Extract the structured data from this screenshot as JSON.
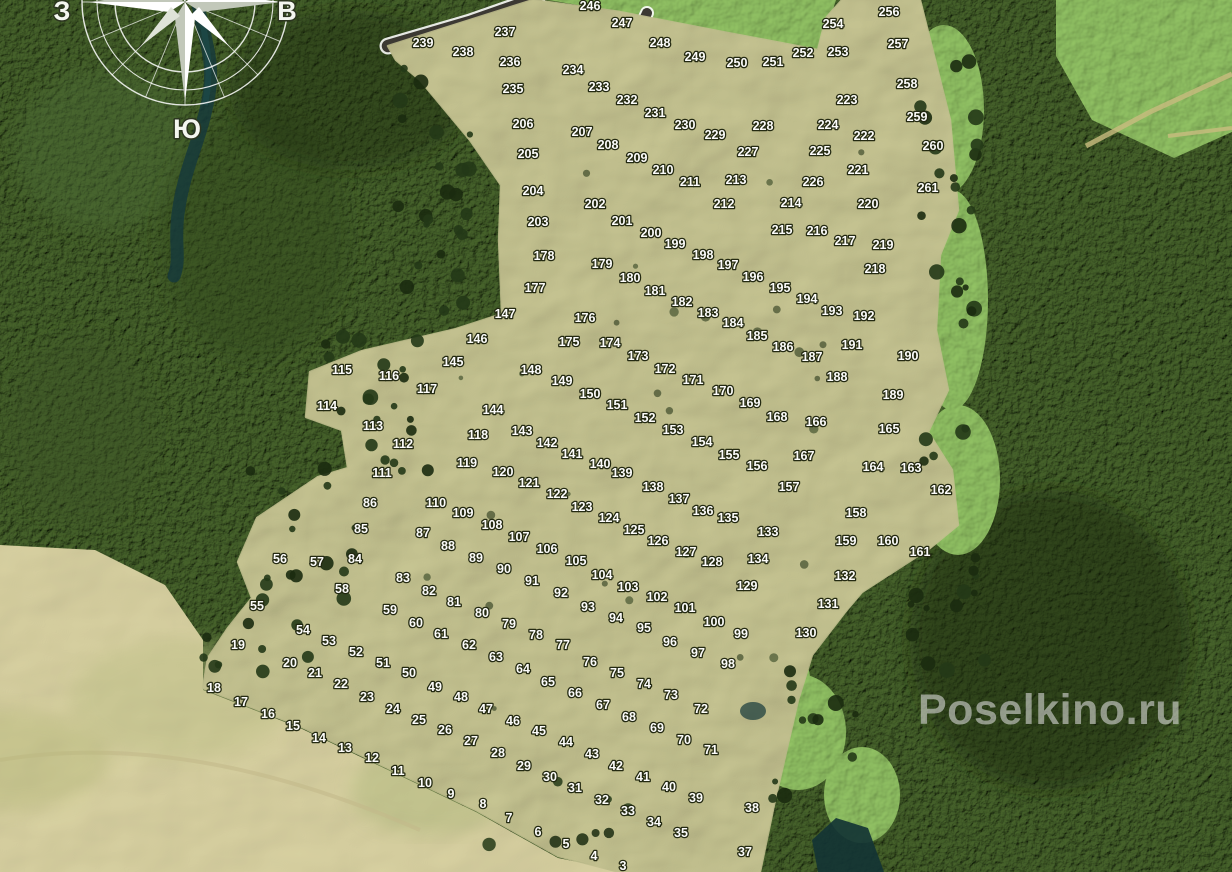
{
  "map": {
    "watermark": "Poselkino.ru",
    "compass": {
      "west": "З",
      "east": "В",
      "south": "Ю"
    },
    "colors": {
      "forest": "#243417",
      "field": "#bdc183",
      "pale_field": "#d6cd9c",
      "meadow": "#7fae56",
      "road": "#3c3933",
      "boundary_line": "#ffffff",
      "water": "#16393b",
      "plot_label": "#ffffff",
      "watermark": "#dedede"
    },
    "plots": [
      [
        "3",
        623,
        866
      ],
      [
        "4",
        594,
        856
      ],
      [
        "5",
        566,
        844
      ],
      [
        "6",
        538,
        832
      ],
      [
        "7",
        509,
        818
      ],
      [
        "8",
        483,
        804
      ],
      [
        "9",
        451,
        794
      ],
      [
        "10",
        425,
        783
      ],
      [
        "11",
        398,
        771
      ],
      [
        "12",
        372,
        758
      ],
      [
        "13",
        345,
        748
      ],
      [
        "14",
        319,
        738
      ],
      [
        "15",
        293,
        726
      ],
      [
        "16",
        268,
        714
      ],
      [
        "17",
        241,
        702
      ],
      [
        "18",
        214,
        688
      ],
      [
        "19",
        238,
        645
      ],
      [
        "20",
        290,
        663
      ],
      [
        "21",
        315,
        673
      ],
      [
        "22",
        341,
        684
      ],
      [
        "23",
        367,
        697
      ],
      [
        "24",
        393,
        709
      ],
      [
        "25",
        419,
        720
      ],
      [
        "26",
        445,
        730
      ],
      [
        "27",
        471,
        741
      ],
      [
        "28",
        498,
        753
      ],
      [
        "29",
        524,
        766
      ],
      [
        "30",
        550,
        777
      ],
      [
        "31",
        575,
        788
      ],
      [
        "32",
        602,
        800
      ],
      [
        "33",
        628,
        811
      ],
      [
        "34",
        654,
        822
      ],
      [
        "35",
        681,
        833
      ],
      [
        "37",
        745,
        852
      ],
      [
        "38",
        752,
        808
      ],
      [
        "39",
        696,
        798
      ],
      [
        "40",
        669,
        787
      ],
      [
        "41",
        643,
        777
      ],
      [
        "42",
        616,
        766
      ],
      [
        "43",
        592,
        754
      ],
      [
        "44",
        566,
        742
      ],
      [
        "45",
        539,
        731
      ],
      [
        "46",
        513,
        721
      ],
      [
        "47",
        486,
        709
      ],
      [
        "48",
        461,
        697
      ],
      [
        "49",
        435,
        687
      ],
      [
        "50",
        409,
        673
      ],
      [
        "51",
        383,
        663
      ],
      [
        "52",
        356,
        652
      ],
      [
        "53",
        329,
        641
      ],
      [
        "54",
        303,
        630
      ],
      [
        "55",
        257,
        606
      ],
      [
        "56",
        280,
        559
      ],
      [
        "57",
        317,
        562
      ],
      [
        "58",
        342,
        589
      ],
      [
        "59",
        390,
        610
      ],
      [
        "60",
        416,
        623
      ],
      [
        "61",
        441,
        634
      ],
      [
        "62",
        469,
        645
      ],
      [
        "63",
        496,
        657
      ],
      [
        "64",
        523,
        669
      ],
      [
        "65",
        548,
        682
      ],
      [
        "66",
        575,
        693
      ],
      [
        "67",
        603,
        705
      ],
      [
        "68",
        629,
        717
      ],
      [
        "69",
        657,
        728
      ],
      [
        "70",
        684,
        740
      ],
      [
        "71",
        711,
        750
      ],
      [
        "72",
        701,
        709
      ],
      [
        "73",
        671,
        695
      ],
      [
        "74",
        644,
        684
      ],
      [
        "75",
        617,
        673
      ],
      [
        "76",
        590,
        662
      ],
      [
        "77",
        563,
        645
      ],
      [
        "78",
        536,
        635
      ],
      [
        "79",
        509,
        624
      ],
      [
        "80",
        482,
        613
      ],
      [
        "81",
        454,
        602
      ],
      [
        "82",
        429,
        591
      ],
      [
        "83",
        403,
        578
      ],
      [
        "84",
        355,
        559
      ],
      [
        "85",
        361,
        529
      ],
      [
        "86",
        370,
        503
      ],
      [
        "87",
        423,
        533
      ],
      [
        "88",
        448,
        546
      ],
      [
        "89",
        476,
        558
      ],
      [
        "90",
        504,
        569
      ],
      [
        "91",
        532,
        581
      ],
      [
        "92",
        561,
        593
      ],
      [
        "93",
        588,
        607
      ],
      [
        "94",
        616,
        618
      ],
      [
        "95",
        644,
        628
      ],
      [
        "96",
        670,
        642
      ],
      [
        "97",
        698,
        653
      ],
      [
        "98",
        728,
        664
      ],
      [
        "99",
        741,
        634
      ],
      [
        "100",
        714,
        622
      ],
      [
        "101",
        685,
        608
      ],
      [
        "102",
        657,
        597
      ],
      [
        "103",
        628,
        587
      ],
      [
        "104",
        602,
        575
      ],
      [
        "105",
        576,
        561
      ],
      [
        "106",
        547,
        549
      ],
      [
        "107",
        519,
        537
      ],
      [
        "108",
        492,
        525
      ],
      [
        "109",
        463,
        513
      ],
      [
        "110",
        436,
        503
      ],
      [
        "111",
        382,
        473
      ],
      [
        "112",
        403,
        444
      ],
      [
        "113",
        373,
        426
      ],
      [
        "114",
        327,
        406
      ],
      [
        "115",
        342,
        370
      ],
      [
        "116",
        389,
        376
      ],
      [
        "117",
        427,
        389
      ],
      [
        "118",
        478,
        435
      ],
      [
        "119",
        467,
        463
      ],
      [
        "120",
        503,
        472
      ],
      [
        "121",
        529,
        483
      ],
      [
        "122",
        557,
        494
      ],
      [
        "123",
        582,
        507
      ],
      [
        "124",
        609,
        518
      ],
      [
        "125",
        634,
        530
      ],
      [
        "126",
        658,
        541
      ],
      [
        "127",
        686,
        552
      ],
      [
        "128",
        712,
        562
      ],
      [
        "129",
        747,
        586
      ],
      [
        "130",
        806,
        633
      ],
      [
        "131",
        828,
        604
      ],
      [
        "132",
        845,
        576
      ],
      [
        "133",
        768,
        532
      ],
      [
        "134",
        758,
        559
      ],
      [
        "135",
        728,
        518
      ],
      [
        "136",
        703,
        511
      ],
      [
        "137",
        679,
        499
      ],
      [
        "138",
        653,
        487
      ],
      [
        "139",
        622,
        473
      ],
      [
        "140",
        600,
        464
      ],
      [
        "141",
        572,
        454
      ],
      [
        "142",
        547,
        443
      ],
      [
        "143",
        522,
        431
      ],
      [
        "144",
        493,
        410
      ],
      [
        "145",
        453,
        362
      ],
      [
        "146",
        477,
        339
      ],
      [
        "147",
        505,
        314
      ],
      [
        "148",
        531,
        370
      ],
      [
        "149",
        562,
        381
      ],
      [
        "150",
        590,
        394
      ],
      [
        "151",
        617,
        405
      ],
      [
        "152",
        645,
        418
      ],
      [
        "153",
        673,
        430
      ],
      [
        "154",
        702,
        442
      ],
      [
        "155",
        729,
        455
      ],
      [
        "156",
        757,
        466
      ],
      [
        "157",
        789,
        487
      ],
      [
        "158",
        856,
        513
      ],
      [
        "159",
        846,
        541
      ],
      [
        "160",
        888,
        541
      ],
      [
        "161",
        920,
        552
      ],
      [
        "162",
        941,
        490
      ],
      [
        "163",
        911,
        468
      ],
      [
        "164",
        873,
        467
      ],
      [
        "165",
        889,
        429
      ],
      [
        "166",
        816,
        422
      ],
      [
        "167",
        804,
        456
      ],
      [
        "168",
        777,
        417
      ],
      [
        "169",
        750,
        403
      ],
      [
        "170",
        723,
        391
      ],
      [
        "171",
        693,
        380
      ],
      [
        "172",
        665,
        369
      ],
      [
        "173",
        638,
        356
      ],
      [
        "174",
        610,
        343
      ],
      [
        "175",
        569,
        342
      ],
      [
        "176",
        585,
        318
      ],
      [
        "177",
        535,
        288
      ],
      [
        "178",
        544,
        256
      ],
      [
        "179",
        602,
        264
      ],
      [
        "180",
        630,
        278
      ],
      [
        "181",
        655,
        291
      ],
      [
        "182",
        682,
        302
      ],
      [
        "183",
        708,
        313
      ],
      [
        "184",
        733,
        323
      ],
      [
        "185",
        757,
        336
      ],
      [
        "186",
        783,
        347
      ],
      [
        "187",
        812,
        357
      ],
      [
        "188",
        837,
        377
      ],
      [
        "189",
        893,
        395
      ],
      [
        "190",
        908,
        356
      ],
      [
        "191",
        852,
        345
      ],
      [
        "192",
        864,
        316
      ],
      [
        "193",
        832,
        311
      ],
      [
        "194",
        807,
        299
      ],
      [
        "195",
        780,
        288
      ],
      [
        "196",
        753,
        277
      ],
      [
        "197",
        728,
        265
      ],
      [
        "198",
        703,
        255
      ],
      [
        "199",
        675,
        244
      ],
      [
        "200",
        651,
        233
      ],
      [
        "201",
        622,
        221
      ],
      [
        "202",
        595,
        204
      ],
      [
        "203",
        538,
        222
      ],
      [
        "204",
        533,
        191
      ],
      [
        "205",
        528,
        154
      ],
      [
        "206",
        523,
        124
      ],
      [
        "207",
        582,
        132
      ],
      [
        "208",
        608,
        145
      ],
      [
        "209",
        637,
        158
      ],
      [
        "210",
        663,
        170
      ],
      [
        "211",
        690,
        182
      ],
      [
        "212",
        724,
        204
      ],
      [
        "213",
        736,
        180
      ],
      [
        "214",
        791,
        203
      ],
      [
        "215",
        782,
        230
      ],
      [
        "216",
        817,
        231
      ],
      [
        "217",
        845,
        241
      ],
      [
        "218",
        875,
        269
      ],
      [
        "219",
        883,
        245
      ],
      [
        "220",
        868,
        204
      ],
      [
        "221",
        858,
        170
      ],
      [
        "222",
        864,
        136
      ],
      [
        "223",
        847,
        100
      ],
      [
        "224",
        828,
        125
      ],
      [
        "225",
        820,
        151
      ],
      [
        "226",
        813,
        182
      ],
      [
        "227",
        748,
        152
      ],
      [
        "228",
        763,
        126
      ],
      [
        "229",
        715,
        135
      ],
      [
        "230",
        685,
        125
      ],
      [
        "231",
        655,
        113
      ],
      [
        "232",
        627,
        100
      ],
      [
        "233",
        599,
        87
      ],
      [
        "234",
        573,
        70
      ],
      [
        "235",
        513,
        89
      ],
      [
        "236",
        510,
        62
      ],
      [
        "237",
        505,
        32
      ],
      [
        "238",
        463,
        52
      ],
      [
        "239",
        423,
        43
      ],
      [
        "246",
        590,
        6
      ],
      [
        "247",
        622,
        23
      ],
      [
        "248",
        660,
        43
      ],
      [
        "249",
        695,
        57
      ],
      [
        "250",
        737,
        63
      ],
      [
        "251",
        773,
        62
      ],
      [
        "252",
        803,
        53
      ],
      [
        "253",
        838,
        52
      ],
      [
        "254",
        833,
        24
      ],
      [
        "256",
        889,
        12
      ],
      [
        "257",
        898,
        44
      ],
      [
        "258",
        907,
        84
      ],
      [
        "259",
        917,
        117
      ],
      [
        "260",
        933,
        146
      ],
      [
        "261",
        928,
        188
      ]
    ]
  }
}
